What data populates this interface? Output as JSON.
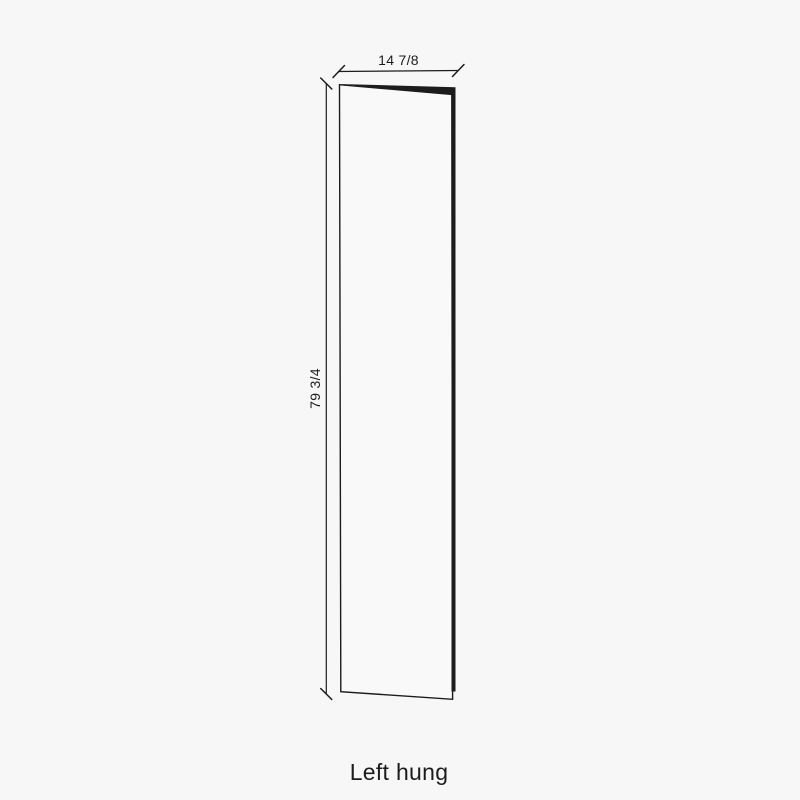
{
  "diagram": {
    "width_label": "14 7/8",
    "height_label": "79 3/4",
    "caption": "Left hung"
  },
  "colors": {
    "background": "#f7f7f7",
    "line": "#1c1c1c",
    "panel_fill": "#f9f9f9"
  }
}
